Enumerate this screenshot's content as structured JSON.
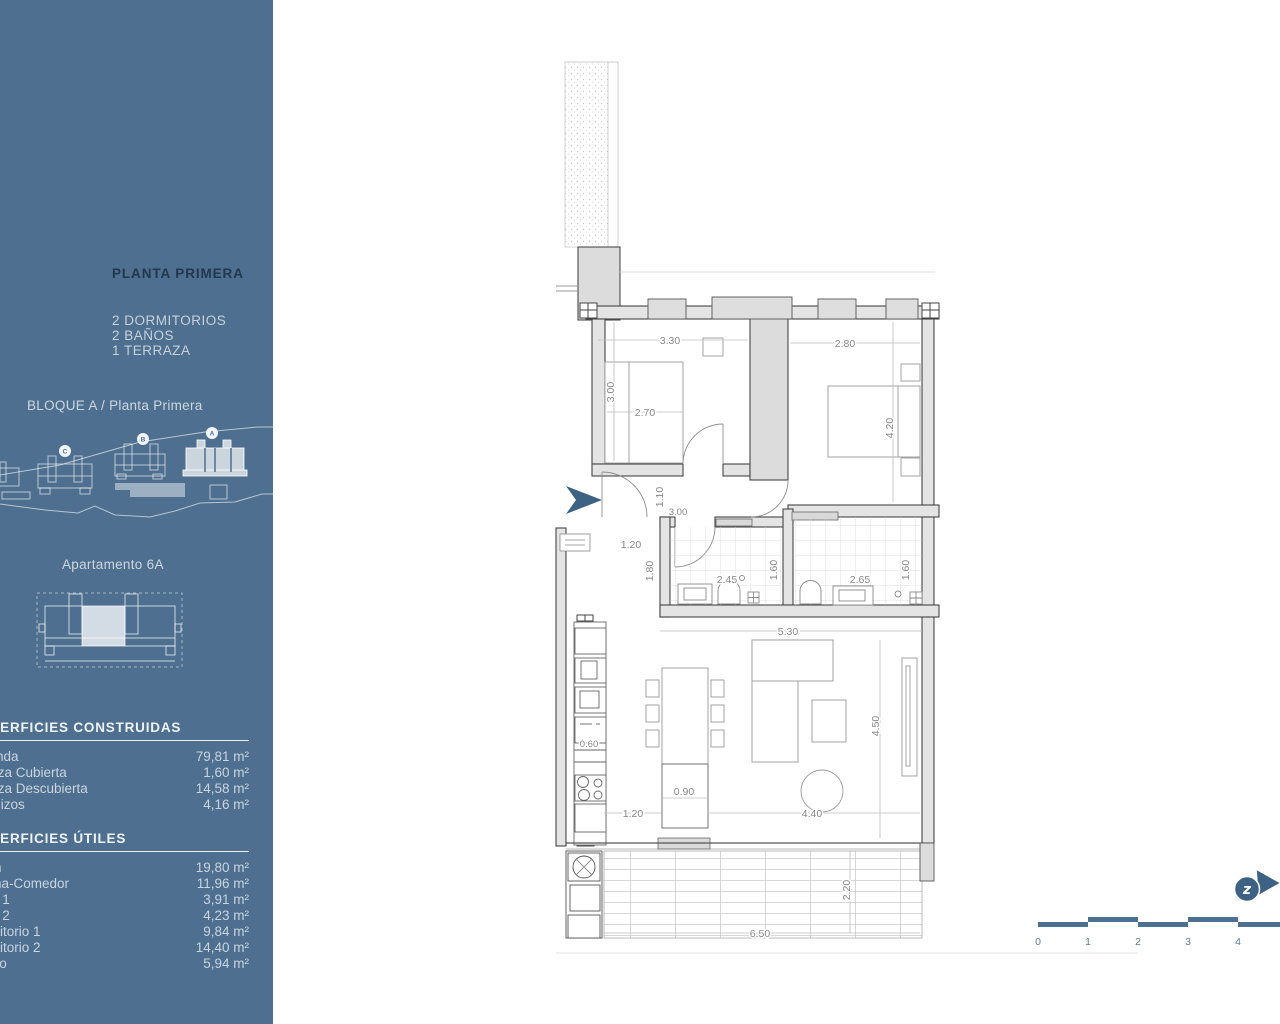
{
  "sidebar": {
    "title": "PLANTA PRIMERA",
    "features": [
      "2 DORMITORIOS",
      "2 BAÑOS",
      "1 TERRAZA"
    ],
    "block_label": "BLOQUE A / Planta Primera",
    "site_badges": [
      "C",
      "B",
      "A"
    ],
    "apartment_label": "Apartamento 6A",
    "surfaces_constructed": {
      "heading": "SUPERFICIES CONSTRUIDAS",
      "rows": [
        {
          "label": "Vivienda",
          "value": "79,81 m²"
        },
        {
          "label": "Terraza Cubierta",
          "value": "1,60 m²"
        },
        {
          "label": "Terraza Descubierta",
          "value": "14,58 m²"
        },
        {
          "label": "Voladizos",
          "value": "4,16 m²"
        }
      ]
    },
    "surfaces_useful": {
      "heading": "SUPERFICIES ÚTILES",
      "rows": [
        {
          "label": "Salón",
          "value": "19,80 m²"
        },
        {
          "label": "Cocina-Comedor",
          "value": "11,96 m²"
        },
        {
          "label": "Baño 1",
          "value": "3,91 m²"
        },
        {
          "label": "Baño 2",
          "value": "4,23 m²"
        },
        {
          "label": "Dormitorio 1",
          "value": "9,84 m²"
        },
        {
          "label": "Dormitorio 2",
          "value": "14,40 m²"
        },
        {
          "label": "Pasillo",
          "value": "5,94 m²"
        }
      ]
    }
  },
  "plan": {
    "dims": {
      "bed1_width": "3.30",
      "bed2_width": "2.80",
      "bed1_height": "3.00",
      "bed1_bed": "2.70",
      "bed2_height": "4.20",
      "hall_width": "1.10",
      "hall_length": "3.00",
      "entry": "1.20",
      "bath1_depth": "1.80",
      "bath1_width": "2.45",
      "bath1_height": "1.60",
      "bath2_width": "2.65",
      "bath2_height": "1.60",
      "living_width": "5.30",
      "kitchen_depth": "0.60",
      "living_height": "4.50",
      "island_width": "0.90",
      "living_left": "1.20",
      "living_right": "4.40",
      "terrace_width": "6.50",
      "terrace_depth": "2.20"
    },
    "scale_labels": [
      "0",
      "1",
      "2",
      "3",
      "4"
    ],
    "north_mark": "z",
    "colors": {
      "sidebar_bg": "#4E6F8F",
      "accent_blue": "#3E6284"
    }
  }
}
